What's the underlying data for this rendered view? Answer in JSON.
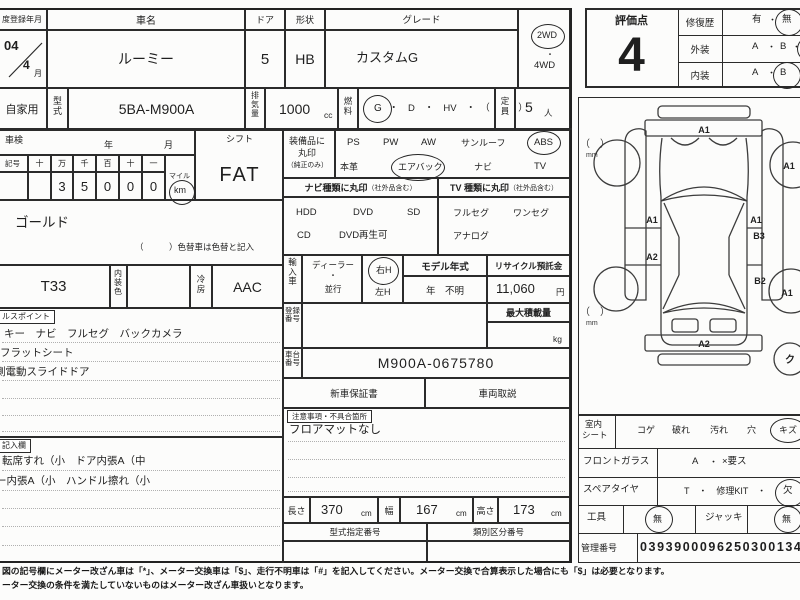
{
  "header": {
    "reg_date_label": "度登録年月",
    "reg_year": "04",
    "reg_month": "4",
    "reg_month_unit": "月",
    "car_name_label": "車名",
    "car_name": "ルーミー",
    "door_label": "ドア",
    "door_value": "5",
    "shape_label": "形状",
    "shape_value": "HB",
    "grade_label": "グレード",
    "grade_value": "カスタムG",
    "drive_2wd": "2WD",
    "drive_sep": "・",
    "drive_4wd": "4WD"
  },
  "engine_row": {
    "use_type": "自家用",
    "model_code_label": "型式",
    "model_code": "5BA-M900A",
    "displacement_label": "排気量",
    "displacement_value": "1000",
    "displacement_unit": "cc",
    "fuel_label": "燃料",
    "fuel_selected": "G",
    "fuel_options": "・　D　・　HV　・　（　　　）",
    "capacity_label": "定員",
    "capacity_value": "5",
    "capacity_unit": "人"
  },
  "inspection": {
    "label": "車検",
    "year": "年",
    "month": "月"
  },
  "odometer": {
    "symbol": "記号",
    "cols": [
      "十",
      "万",
      "千",
      "百",
      "十",
      "一"
    ],
    "digits": [
      "",
      "3",
      "5",
      "0",
      "0",
      "0"
    ],
    "mile": "マイル",
    "km": "km"
  },
  "shift": {
    "label": "シフト",
    "value": "FAT"
  },
  "color": {
    "body": "ゴールド",
    "note": "（　　　）色替車は色替と記入",
    "code": "T33",
    "interior_label": "内装色",
    "ac_label": "冷房",
    "ac_value": "AAC"
  },
  "equipment": {
    "label1": "装備品に",
    "label2": "丸印",
    "label3": "（純正のみ）",
    "row1": [
      "PS",
      "PW",
      "AW",
      "サンルーフ",
      "ABS"
    ],
    "row2": [
      "本革",
      "エアバック",
      "ナビ",
      "TV"
    ]
  },
  "nav": {
    "header": "ナビ種類に丸印",
    "header_sub": "（社外品含む）",
    "row1": [
      "HDD",
      "DVD",
      "SD"
    ],
    "row2": [
      "CD",
      "DVD再生可"
    ]
  },
  "tv": {
    "header": "TV 種類に丸印",
    "header_sub": "（社外品含む）",
    "row1": [
      "フルセグ",
      "ワンセグ"
    ],
    "row2": [
      "アナログ"
    ]
  },
  "import": {
    "label": "輸入車",
    "dealer": "ディーラー",
    "sep": "・",
    "parallel": "並行",
    "right_h": "右H",
    "left_h": "左H",
    "model_year_label": "モデル年式",
    "model_year_value": "年　不明",
    "recycle_label": "リサイクル預託金",
    "recycle_value": "11,060",
    "recycle_unit": "円"
  },
  "registration": {
    "label": "登録番号",
    "max_load_label": "最大積載量",
    "max_load_unit": "kg"
  },
  "chassis": {
    "label": "車台番号",
    "value": "M900A-0675780"
  },
  "docs": {
    "warranty": "新車保証書",
    "manual": "車両取説"
  },
  "caution": {
    "tag": "注意事項・不具合箇所",
    "line1": "フロアマットなし"
  },
  "dimensions": {
    "length_label": "長さ",
    "length": "370",
    "width_label": "幅",
    "width": "167",
    "height_label": "高さ",
    "height": "173",
    "unit": "cm"
  },
  "type_numbers": {
    "designation": "型式指定番号",
    "classification": "類別区分番号"
  },
  "sales_points": {
    "tag": "ルスポイント",
    "lines": [
      "キー　ナビ　フルセグ　バックカメラ",
      "フラットシート",
      "側電動スライドドア"
    ]
  },
  "inspector_notes": {
    "tag": "記入欄",
    "lines": [
      "転席すれ（小　ドア内張A（中",
      "ー内張A（小　ハンドル擦れ（小"
    ]
  },
  "evaluation": {
    "score_label": "評価点",
    "score": "4",
    "repair_label": "修復歴",
    "repair_yes": "有",
    "sep": "・",
    "repair_no": "無",
    "exterior_label": "外装",
    "ext_a": "A",
    "ext_b": "B",
    "interior_label": "内装",
    "int_a": "A",
    "int_b": "B"
  },
  "diagram": {
    "front_bumper": "A1",
    "front_right_wheel": "A1",
    "left_front_door": "A1",
    "right_front_door": "A1",
    "right_b3": "B3",
    "left_rear_door": "A2",
    "right_rear_b2": "B2",
    "rear_right_wheel": "A1",
    "rear_bumper": "A2",
    "mm_paren": "（　）",
    "mm_unit": "mm",
    "cut_mark": "ク"
  },
  "condition": {
    "seat_label1": "室内",
    "seat_label2": "シート",
    "seat_items": [
      "コゲ",
      "破れ",
      "汚れ",
      "穴",
      "キズ"
    ],
    "glass_label": "フロントガラス",
    "glass_a": "A",
    "glass_sep": "・",
    "glass_x": "×要ス",
    "spare_label": "スペアタイヤ",
    "spare_value": "T　・　修理KIT　・",
    "spare_missing": "欠",
    "tools_label": "工具",
    "tools_value": "無",
    "jack_label": "ジャッキ",
    "jack_value": "無"
  },
  "management": {
    "label": "管理番号",
    "number": "03939000962503001343"
  },
  "footer": {
    "line1": "図の記号欄にメーター改ざん車は「*」、メーター交換車は「$」、走行不明車は「#」を記入してください。メーター交換で合算表示した場合にも「$」は必要となります。",
    "line2": "ーター交換の条件を満たしていないものはメーター改ざん車扱いとなります。"
  }
}
